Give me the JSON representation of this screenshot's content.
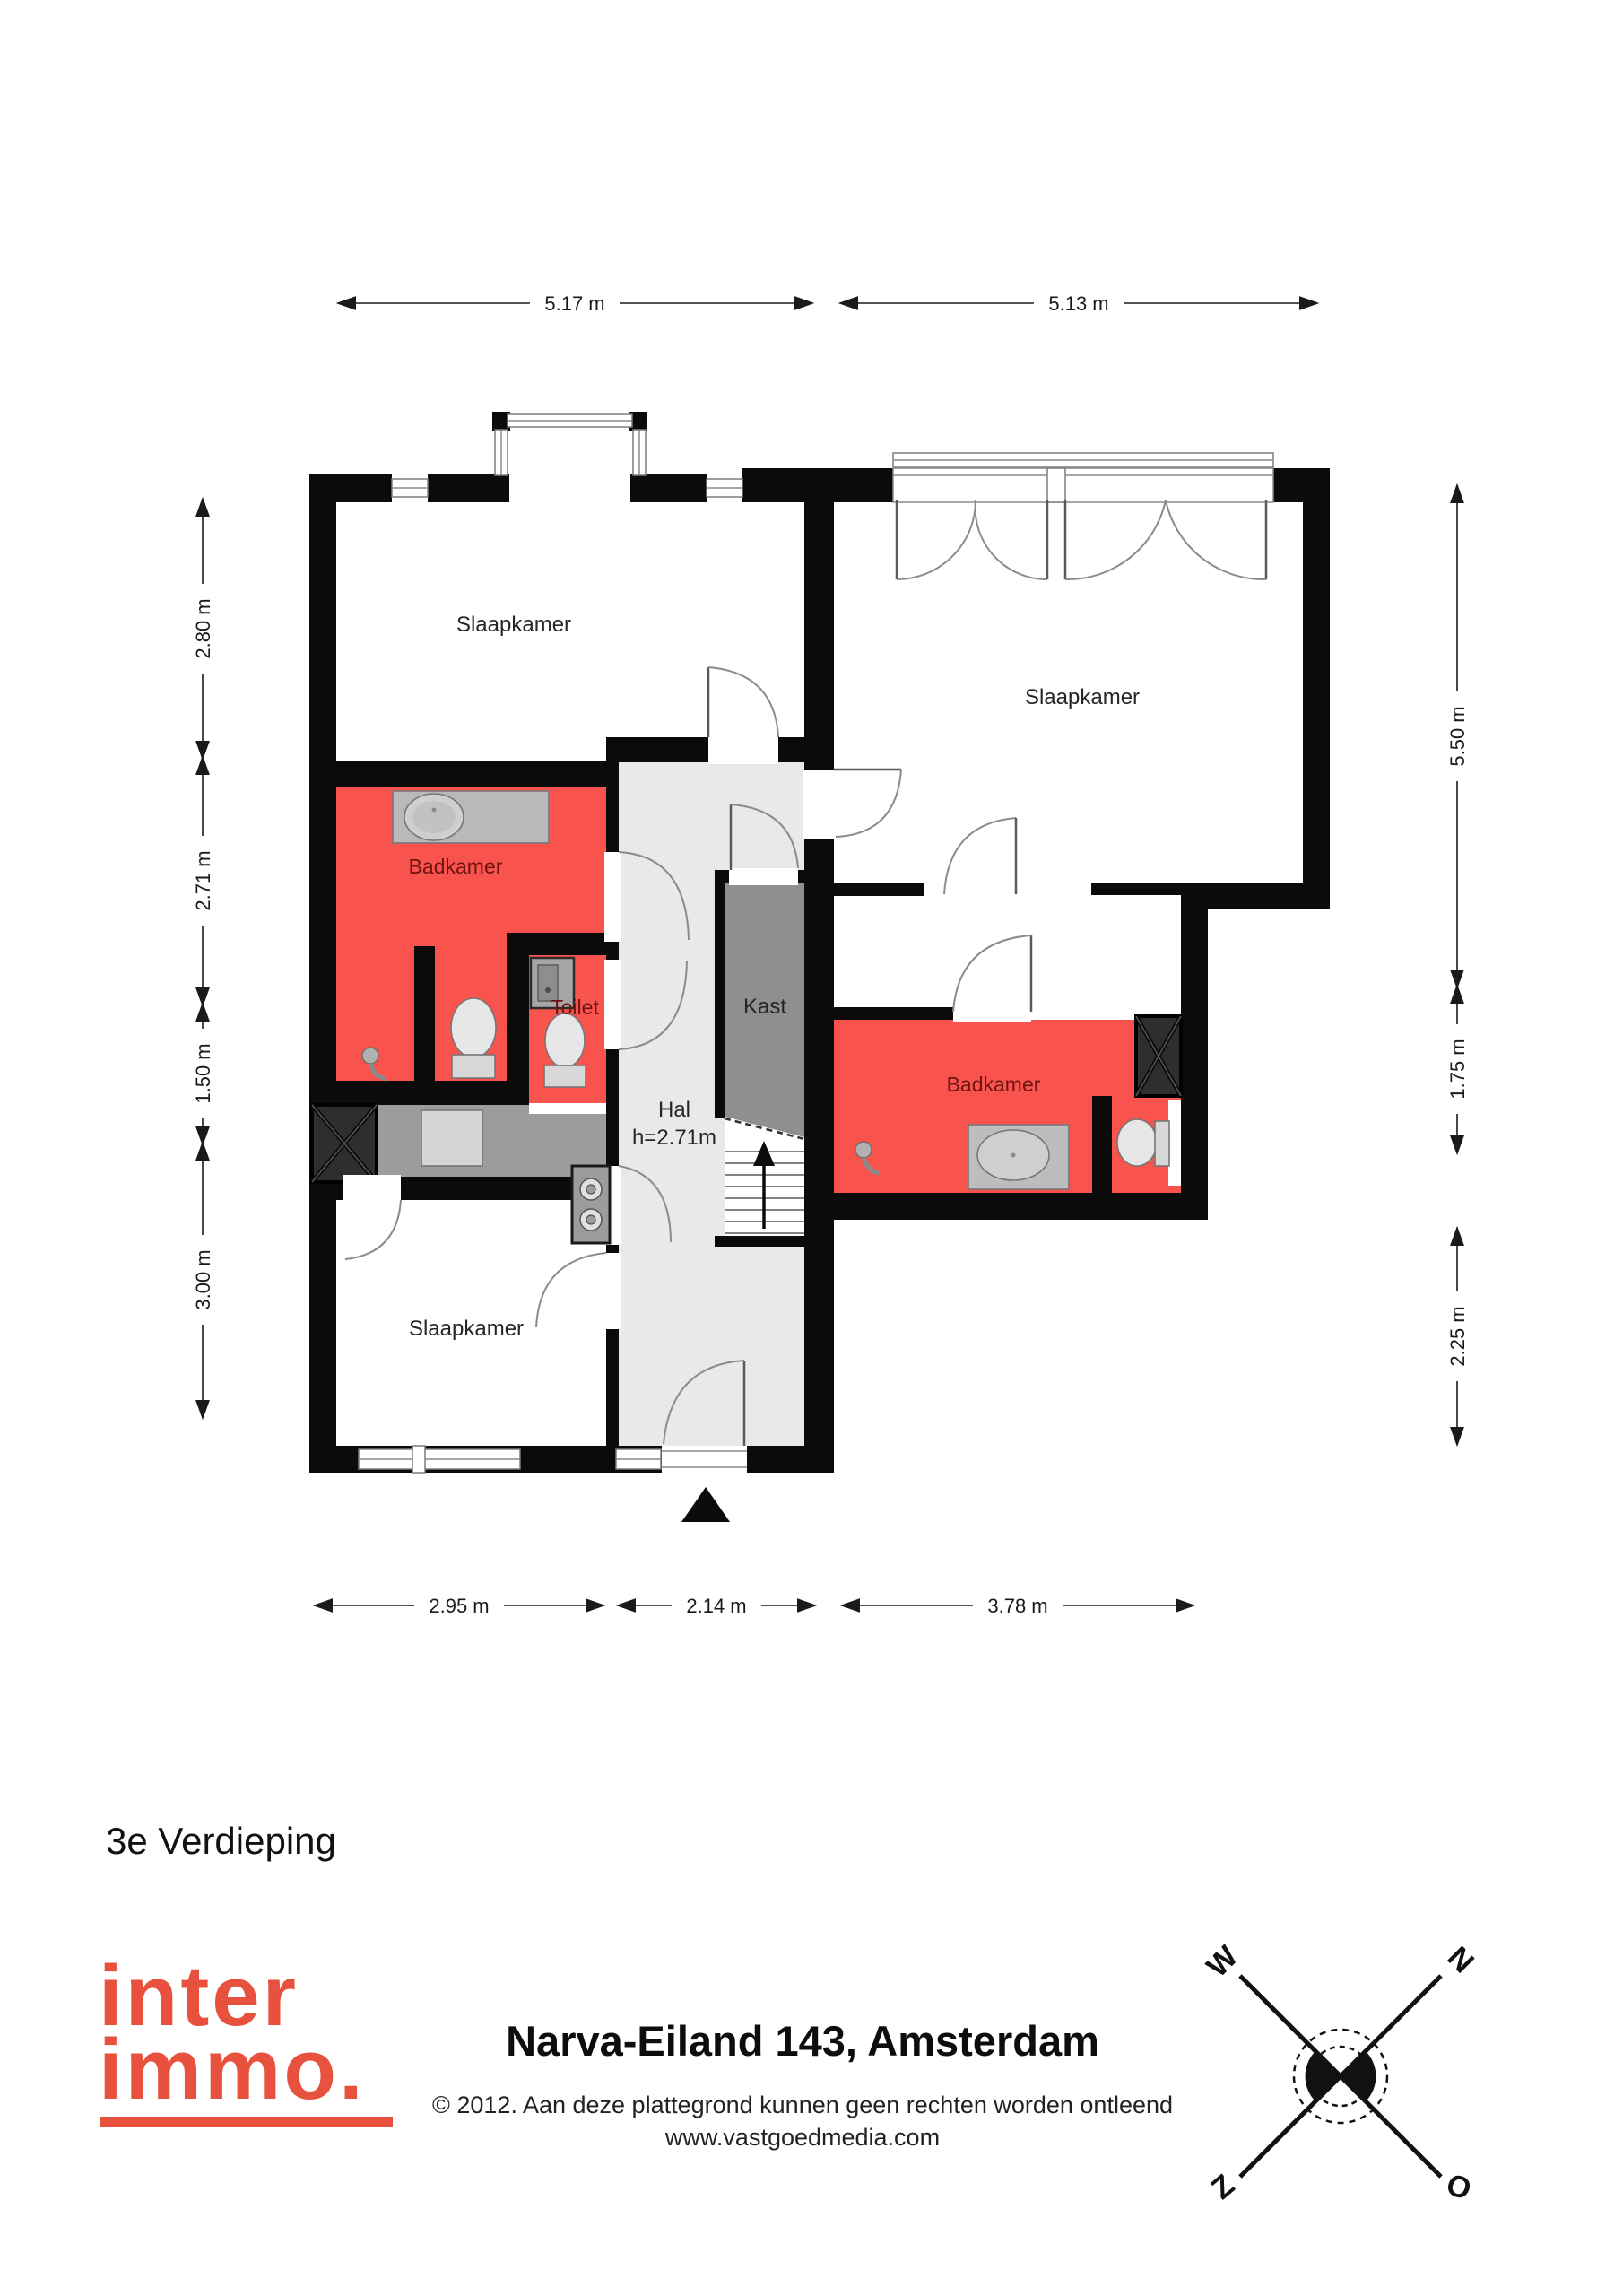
{
  "floor_label": "3e Verdieping",
  "rooms": {
    "slaapkamer_top_left": "Slaapkamer",
    "slaapkamer_top_right": "Slaapkamer",
    "slaapkamer_bottom": "Slaapkamer",
    "badkamer_left": "Badkamer",
    "badkamer_right": "Badkamer",
    "toilet": "Toilet",
    "kast": "Kast",
    "hal": "Hal",
    "hal_height": "h=2.71m"
  },
  "dimensions": {
    "top": [
      "5.17 m",
      "5.13 m"
    ],
    "left": [
      "2.80 m",
      "2.71 m",
      "1.50 m",
      "3.00 m"
    ],
    "right": [
      "5.50 m",
      "1.75 m",
      "2.25 m"
    ],
    "bottom": [
      "2.95 m",
      "2.14 m",
      "3.78 m"
    ]
  },
  "compass": {
    "n": "N",
    "o": "O",
    "z": "Z",
    "w": "W"
  },
  "logo": {
    "line1": "inter",
    "line2": "immo."
  },
  "footer": {
    "title": "Narva-Eiland 143, Amsterdam",
    "copyright": "© 2012. Aan deze plattegrond kunnen geen rechten worden ontleend",
    "website": "www.vastgoedmedia.com"
  },
  "colors": {
    "highlight_room": "#f9534d",
    "room_label_dark_red": "#6e1410",
    "hal_fill": "#e9e9e9",
    "kast_fill": "#8f8f8f",
    "utility_fill": "#9c9c9c",
    "wall": "#0b0b0b",
    "logo_red": "#e8513d"
  }
}
